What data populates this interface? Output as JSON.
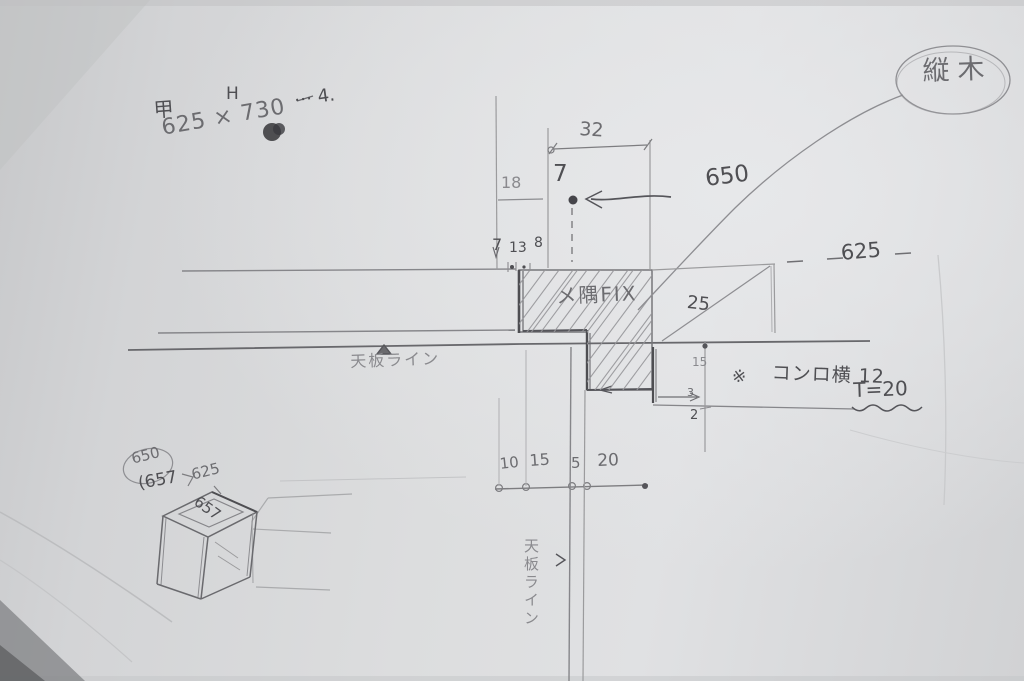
{
  "photo": {
    "notes_top_left": {
      "mark": "甲",
      "height_label": "H",
      "size": "625 × 730",
      "suffix": "⋯ 4."
    },
    "stamp_top_right": {
      "label": "縦木"
    },
    "dims": {
      "top_width": "32",
      "top_offset": "18",
      "top_small": "7",
      "arrow_value": "650",
      "spacing": [
        "7",
        "13",
        "8"
      ],
      "right_level": "625",
      "right_gap": "25",
      "step": [
        "15",
        "3",
        "2"
      ],
      "bottom": [
        "10",
        "15",
        "5",
        "20"
      ]
    },
    "labels": {
      "hatch": "メ隅FIX",
      "counter_line_horizontal": "天板ライン",
      "counter_line_vertical": "天板ライン",
      "note_mark": "※",
      "note_text": "コンロ横 12",
      "note_thickness": "T=20"
    },
    "unit_sketch": {
      "circled": "650",
      "alt_value": "(657",
      "top_edge": "625",
      "side_edge": "657"
    }
  }
}
